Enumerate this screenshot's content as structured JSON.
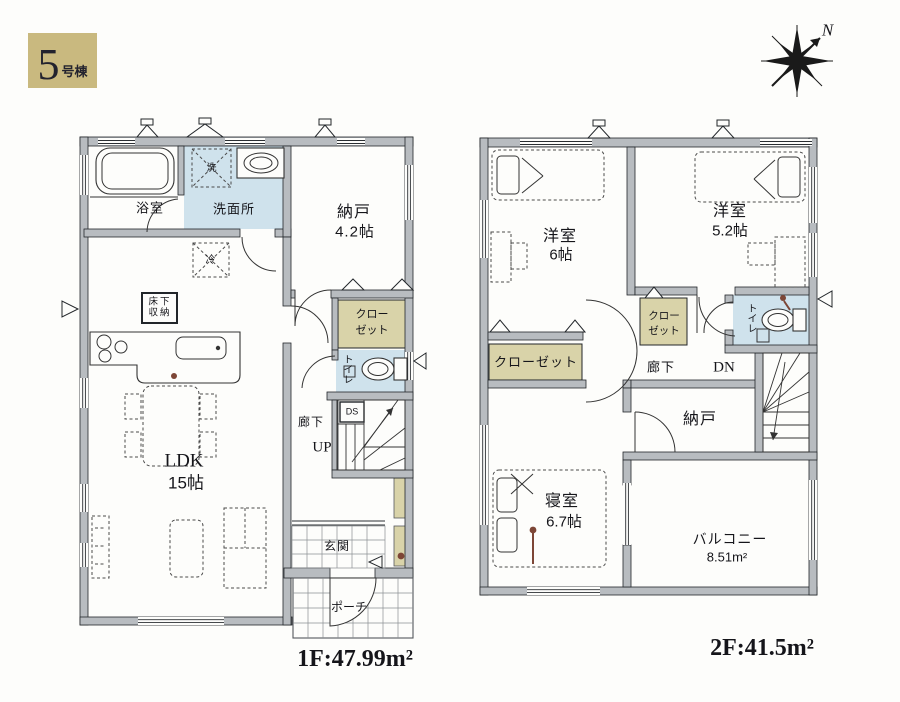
{
  "page": {
    "badge": {
      "number": "5",
      "suffix": "号棟"
    },
    "compass": {
      "north": "N"
    }
  },
  "floor1": {
    "area_label": "1F:47.99m²",
    "labels": {
      "bath": "浴室",
      "washer": "洗",
      "washroom": "洗面所",
      "storage": "納戸",
      "storage_size": "4.2帖",
      "fridge": "冷",
      "underfloor_line1": "床下",
      "underfloor_line2": "収納",
      "closet_line1": "クロー",
      "closet_line2": "ゼット",
      "toilet": "トイレ",
      "duct": "DS",
      "hallway": "廊下",
      "stairs_up": "UP",
      "ldk": "LDK",
      "ldk_size": "15帖",
      "entrance": "玄関",
      "porch": "ポーチ"
    }
  },
  "floor2": {
    "area_label": "2F:41.5m²",
    "labels": {
      "west_room_a": "洋室",
      "west_room_a_size": "6帖",
      "west_room_b": "洋室",
      "west_room_b_size": "5.2帖",
      "closet_small_line1": "クロー",
      "closet_small_line2": "ゼット",
      "toilet": "トイレ",
      "closet": "クローゼット",
      "hallway": "廊下",
      "stairs_down": "DN",
      "storage": "納戸",
      "bedroom": "寝室",
      "bedroom_size": "6.7帖",
      "balcony": "バルコニー",
      "balcony_size": "8.51m²"
    }
  },
  "colors": {
    "badge_bg": "#c9b97f",
    "wall_fill": "#b8bcc0",
    "wet_room_blue": "#cfe2ec",
    "closet_tan": "#d9d3a9",
    "line": "#22262a",
    "accent_brown": "#7d4636"
  }
}
